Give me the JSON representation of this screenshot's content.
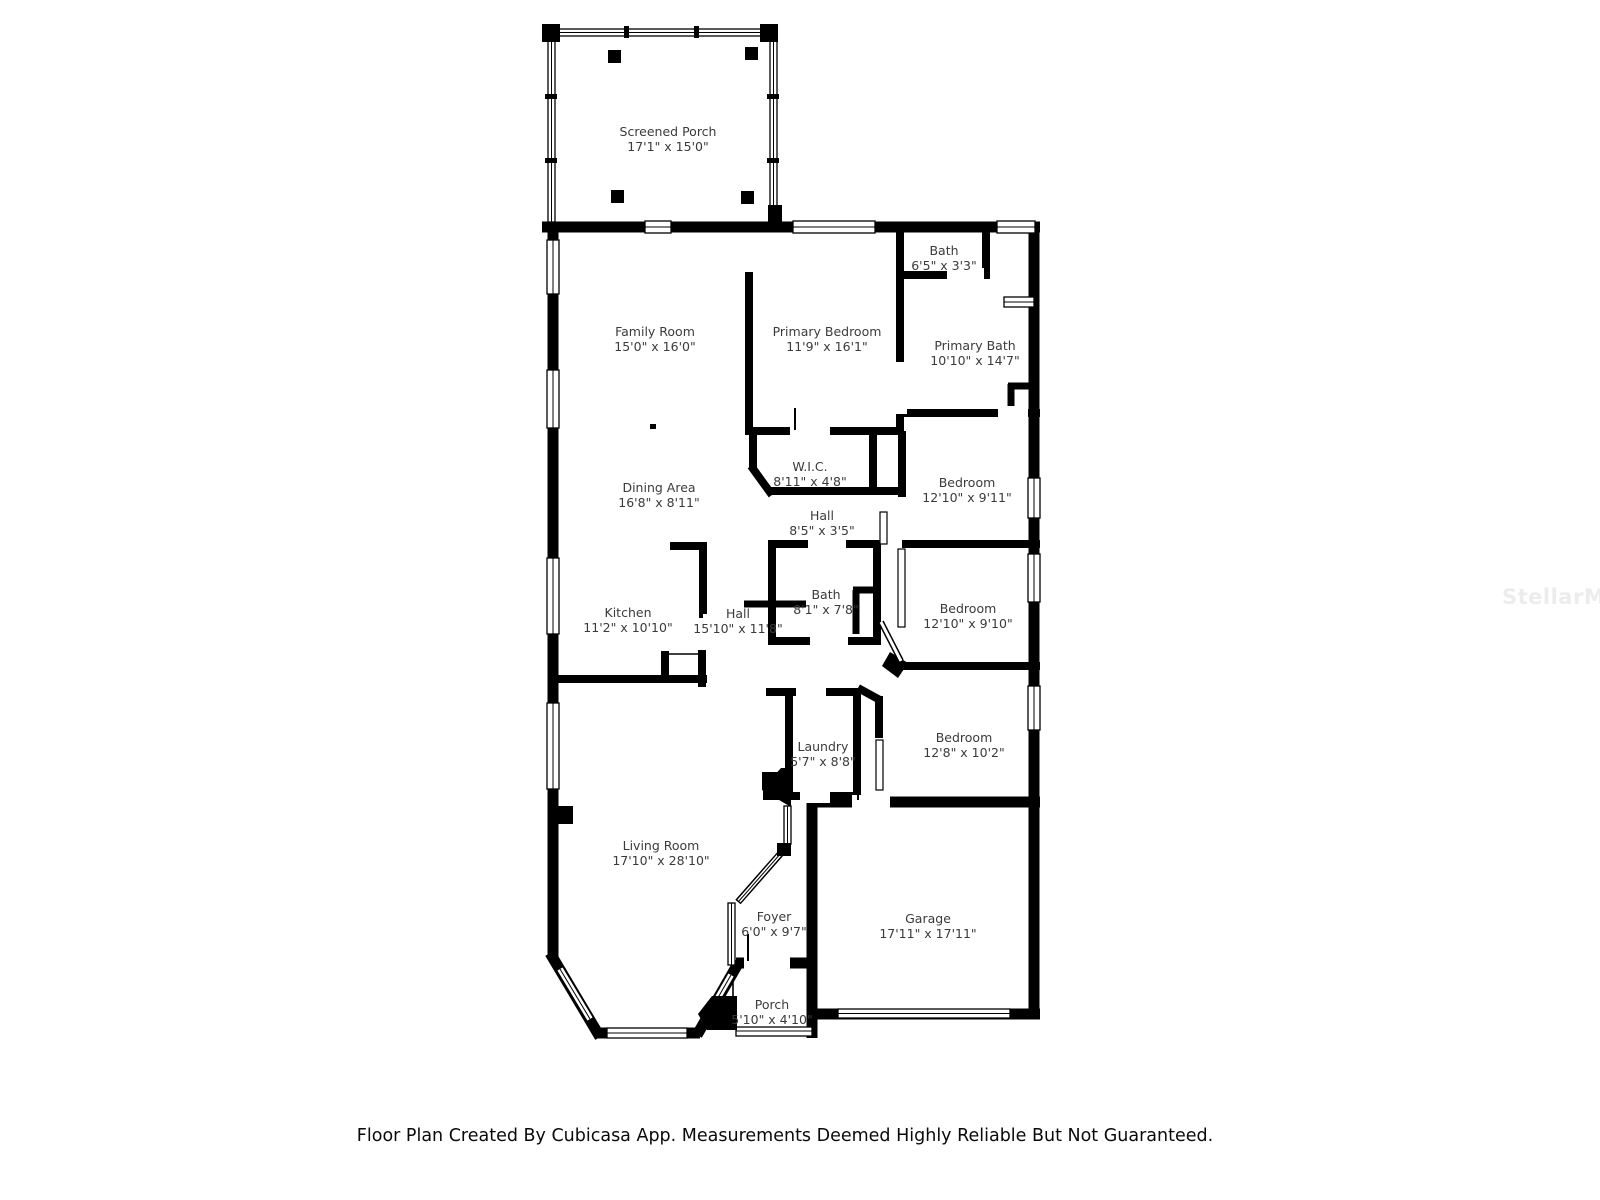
{
  "watermark": {
    "text": "StellarMLS"
  },
  "footer": {
    "disclaimer": "Floor Plan Created By Cubicasa App. Measurements Deemed Highly Reliable But Not Guaranteed."
  },
  "colors": {
    "wall": "#000000",
    "background": "#ffffff",
    "label_text": "#3b3b3b",
    "watermark": "#ececec"
  },
  "rooms": [
    {
      "name": "Screened Porch",
      "dims": "17'1\" x 15'0\""
    },
    {
      "name": "Family Room",
      "dims": "15'0\" x 16'0\""
    },
    {
      "name": "Primary Bedroom",
      "dims": "11'9\" x 16'1\""
    },
    {
      "name": "Bath",
      "dims": "6'5\" x 3'3\""
    },
    {
      "name": "Primary Bath",
      "dims": "10'10\" x 14'7\""
    },
    {
      "name": "W.I.C.",
      "dims": "8'11\" x 4'8\""
    },
    {
      "name": "Bedroom",
      "dims": "12'10\" x 9'11\""
    },
    {
      "name": "Dining Area",
      "dims": "16'8\" x 8'11\""
    },
    {
      "name": "Hall",
      "dims": "8'5\" x 3'5\""
    },
    {
      "name": "Kitchen",
      "dims": "11'2\" x 10'10\""
    },
    {
      "name": "Hall",
      "dims": "15'10\" x 11'8\""
    },
    {
      "name": "Bath",
      "dims": "8'1\" x 7'8\""
    },
    {
      "name": "Bedroom",
      "dims": "12'10\" x 9'10\""
    },
    {
      "name": "Laundry",
      "dims": "5'7\" x 8'8\""
    },
    {
      "name": "Bedroom",
      "dims": "12'8\" x 10'2\""
    },
    {
      "name": "Living Room",
      "dims": "17'10\" x 28'10\""
    },
    {
      "name": "Foyer",
      "dims": "6'0\" x 9'7\""
    },
    {
      "name": "Garage",
      "dims": "17'11\" x 17'11\""
    },
    {
      "name": "Porch",
      "dims": "5'10\" x 4'10\""
    }
  ]
}
